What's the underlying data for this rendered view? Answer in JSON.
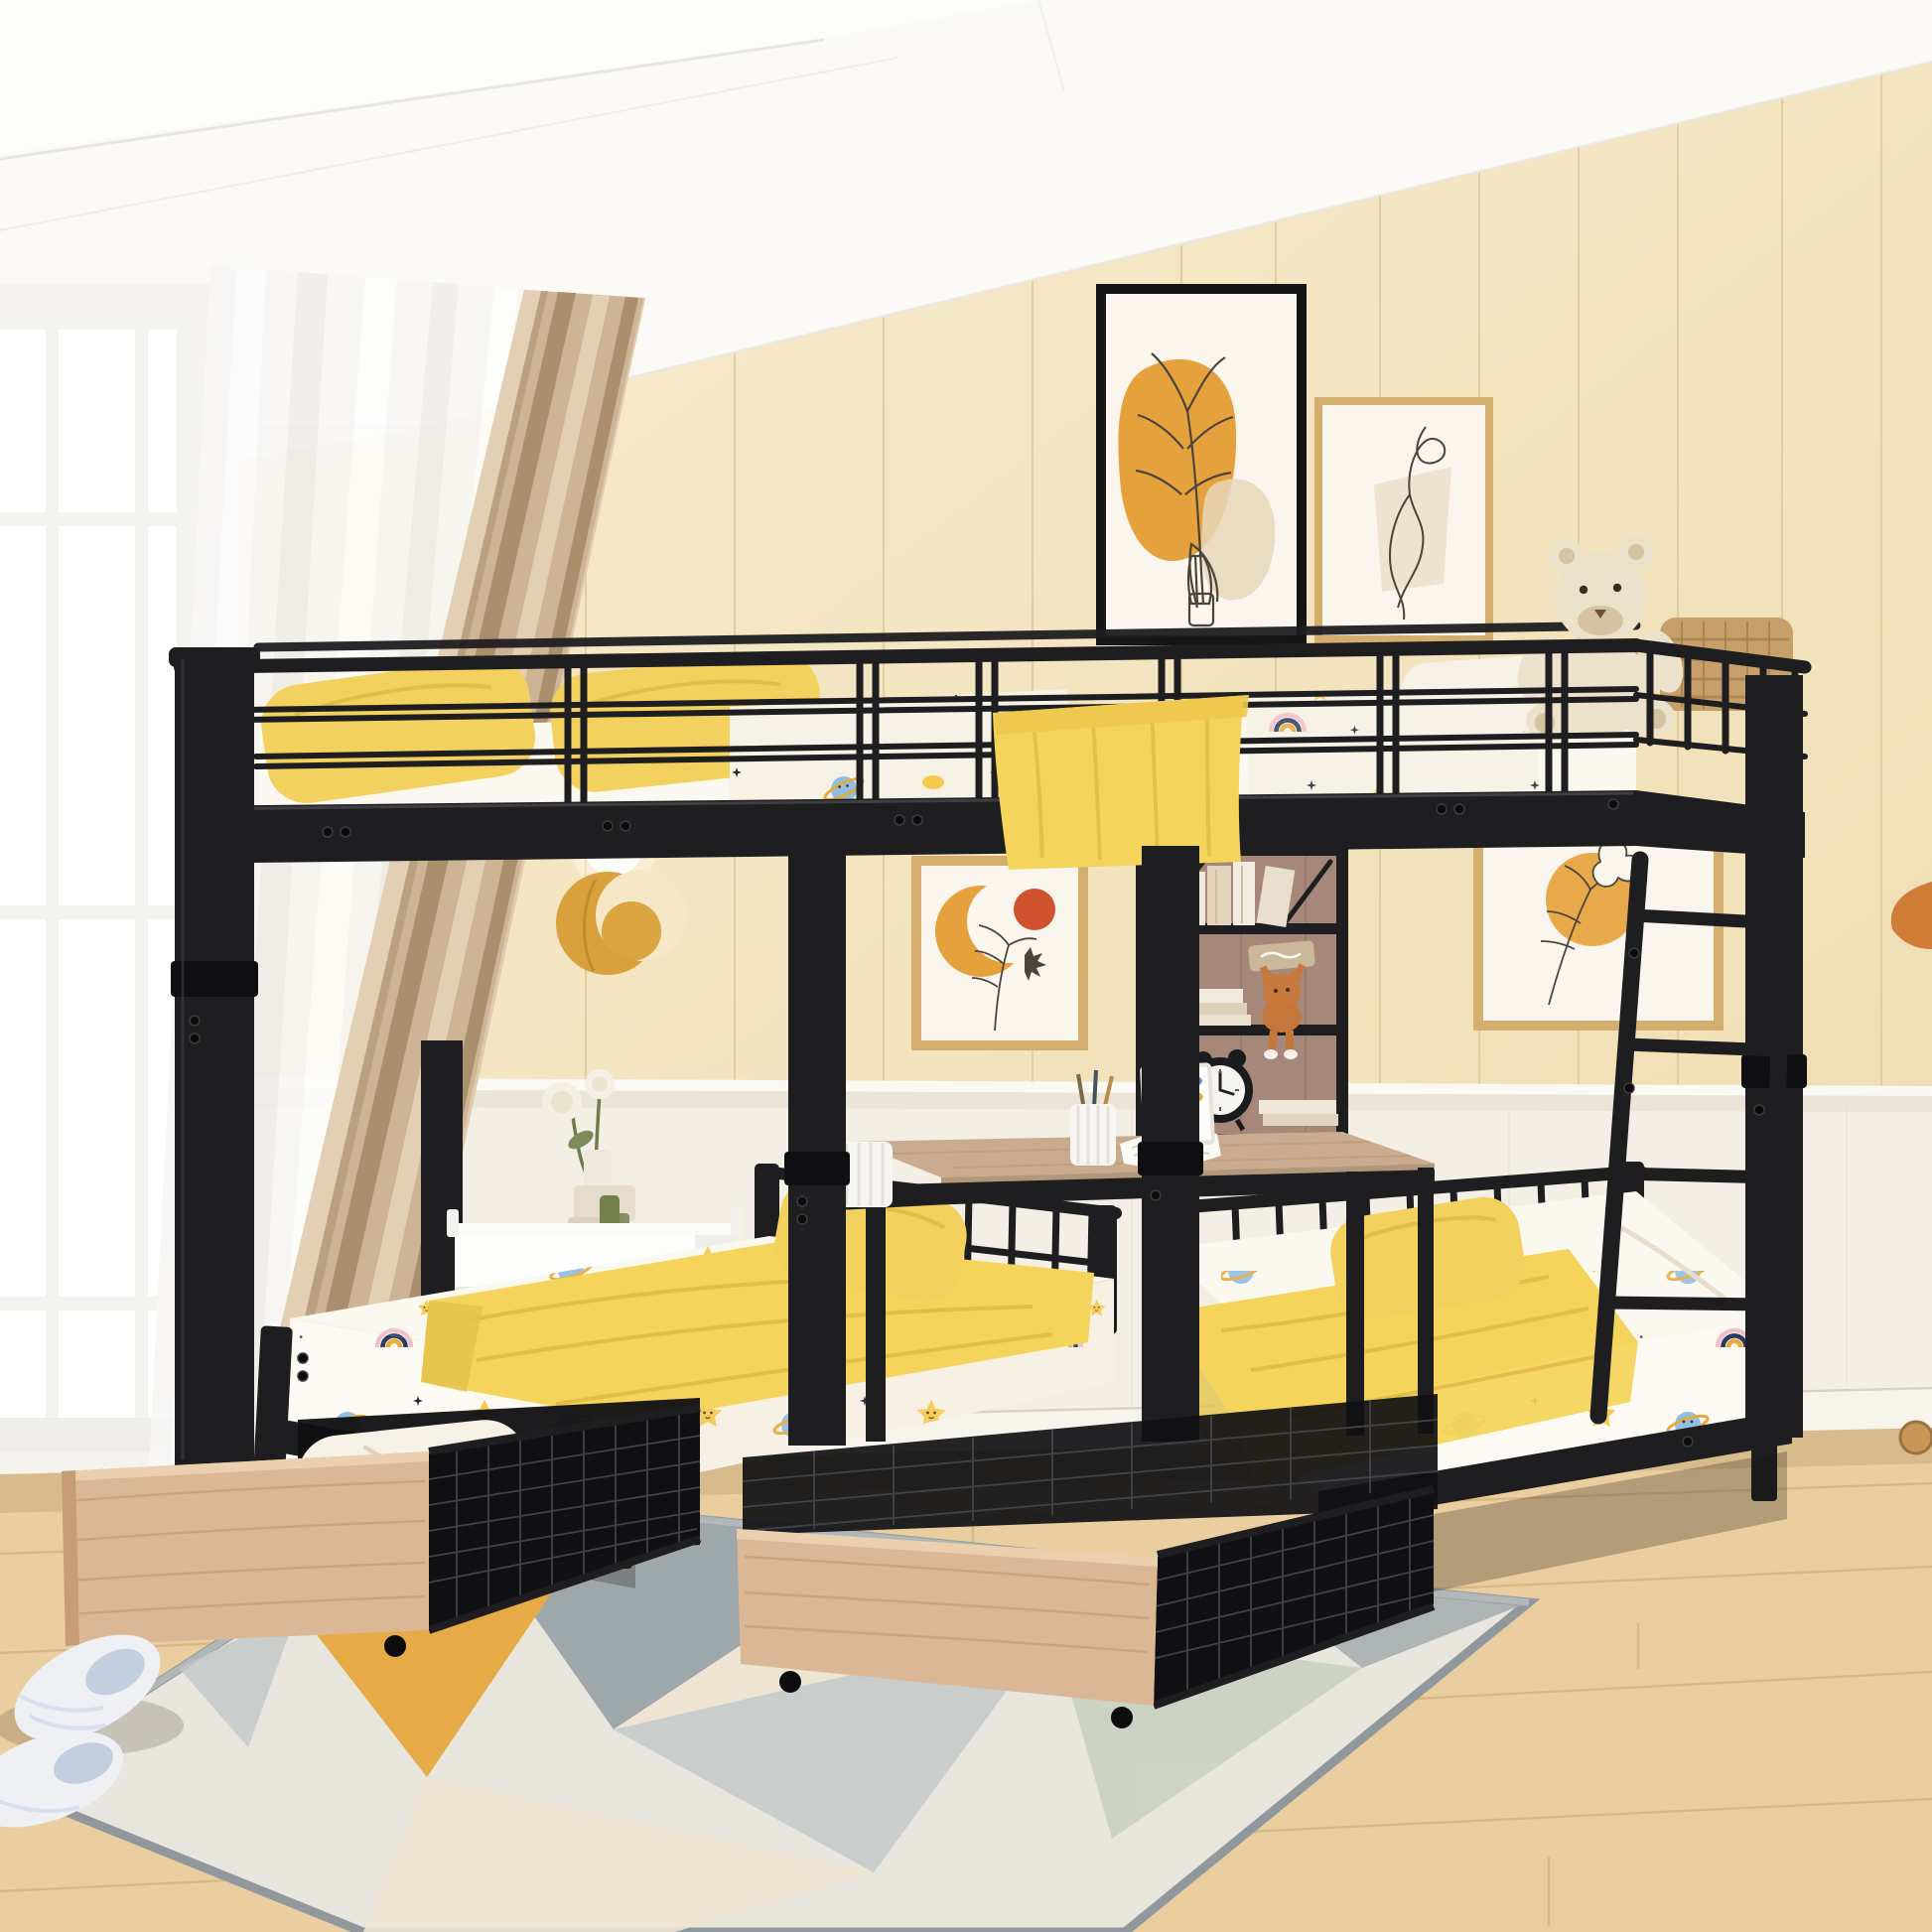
{
  "scene": {
    "description": "Product photograph of a black metal triple bunk bed: a full-size loft bed on top and two twin beds below, separated by a built-in black-frame shelf unit with a small desk; two wheeled under-bed storage drawers with natural wood fronts are pulled out onto a geometric area rug in a cream paneled kids bedroom",
    "room_features": "white tray ceiling, cream vertical wall paneling, white wainscoting, light oak wood floor, white grid window with sheer and beige curtains"
  },
  "objects": {
    "window": "white framed window with muntin grid",
    "sheer_curtain": "white sheer curtain",
    "curtain": "beige linen curtain",
    "artwork_leaf_vase": "black framed abstract print with orange blob and line-art leaves in a bottle",
    "artwork_figure": "tan framed one-line figure drawing",
    "artwork_moon": "small framed print of orange crescent moon, red dot and wildflowers",
    "artwork_flower": "small framed line-art flower print with yellow sun circle",
    "wall_lamp": "gold moon-shaped wall sconce with glowing orb",
    "wall_hook": "orange wooden wall bracket at right edge",
    "door_stopper": "round wooden knob near baseboard at right edge",
    "bunk_bed": "black metal triple bunk bed frame",
    "upper_bed": "full-size top bunk with guard rails",
    "guard_rail": "black tubular safety guard rails",
    "ladder": "black metal ladder at right end",
    "teddy_bear": "cream teddy bear with striped scarf sitting on the top bunk",
    "storage_basket": "woven rattan basket on the top bunk",
    "shelf_unit": "hanging black-frame shelf with wood back panel",
    "shelf_books": "decorative books on shelves",
    "plush_toy": "small brown plush toy holding a wooden sign, legs dangling",
    "alarm_clock": "black twin-bell alarm clock",
    "desk": "built-in wood desk surface",
    "pen_cup": "white ribbed cup with pens and pencils",
    "open_book": "open white book on the desk",
    "photo_frame": "small white frame with colorful stickers",
    "candle_cup": "white ribbed cylinder cup at desk end",
    "nightstand": "white tray-top nightstand",
    "vase_flowers": "white stepped vase with two white roses and green glass bottles",
    "left_twin_bed": "lower left twin bed",
    "right_twin_bed": "lower right twin bed",
    "pillows": "soft yellow pillows",
    "blankets": "yellow throw blankets",
    "drawer_left": "rolling under-bed storage drawer with wood front, wire mesh sides, holding a cream pillow and folded blanket",
    "drawer_right": "rolling under-bed storage drawer with wood front and wire mesh sides",
    "slippers": "pair of fluffy white-blue striped slippers",
    "area_rug": "geometric area rug with gray, cream, orange and sage triangles",
    "wood_floor": "light oak plank floor"
  },
  "bedding_pattern": {
    "fabric": "white kids sheet set",
    "motifs": [
      "smiling yellow star",
      "blue ringed planet",
      "yellow crescent moon",
      "pink-navy-amber rainbow",
      "tiny navy sparkle stars"
    ]
  },
  "palette": {
    "ceiling": "#fbfaf7",
    "ceilingShadow": "#e9e6e1",
    "wall": "#f6e8c6",
    "wallDark": "#eedcb2",
    "wallLine": "#ddc69a",
    "wainscot": "#f3efe4",
    "wainscotShadow": "#d9d2c1",
    "baseboard": "#f7f4ec",
    "floor": "#eaceA0",
    "floorLine": "#c49d63",
    "rugBase": "#e9e6dd",
    "rugGray": "#9aa5a8",
    "rugLightGray": "#c8cccb",
    "rugCream": "#efe7d2",
    "rugOrange": "#e6a83e",
    "rugSage": "#ccd3c1",
    "rugBorder": "#8f989c",
    "winFrame": "#f4f3f0",
    "glass": "#ffffff",
    "sheer": "#f8f7f5",
    "curtain": "#cdb494",
    "curtainHi": "#e3cfb3",
    "curtainSh": "#aa8f6d",
    "metal": "#1e1e21",
    "metalHi": "#46464c",
    "metalDark": "#0f0f11",
    "mattress": "#fbf8f0",
    "pillowYellow": "#f2d15e",
    "pillowShade": "#d8b138",
    "blanket": "#f4d45a",
    "blanketShade": "#dcb53f",
    "softWhite": "#f6f2e6",
    "patYellow": "#f6c94c",
    "patBlue": "#8ec0e5",
    "patBlueDark": "#5f93c2",
    "patNavy": "#2a3a60",
    "patPink": "#f0c0c8",
    "patAmber": "#e8a93e",
    "patInk": "#1d2336",
    "drawerWood": "#dcb795",
    "drawerWoodDark": "#b9906c",
    "deskWood": "#c9ac90",
    "shelfWood": "#a3postion",
    "shelfWoodFix": "#a5887a",
    "shelfWoodDark": "#8c7162",
    "frameTan": "#d3ae6f",
    "artPaper": "#faf6ee",
    "artOrange": "#e5a23c",
    "artRed": "#d0512e",
    "artLine": "#4c443b",
    "artBeige": "#e6d7ba",
    "lampGold": "#d9a13b",
    "teddyFur": "#ece1cb",
    "teddyDark": "#d5c2a0",
    "basket": "#c69f6a",
    "bottleGreen": "#76804e",
    "slipper": "#eef0f4",
    "slipperShade": "#c3cede"
  }
}
